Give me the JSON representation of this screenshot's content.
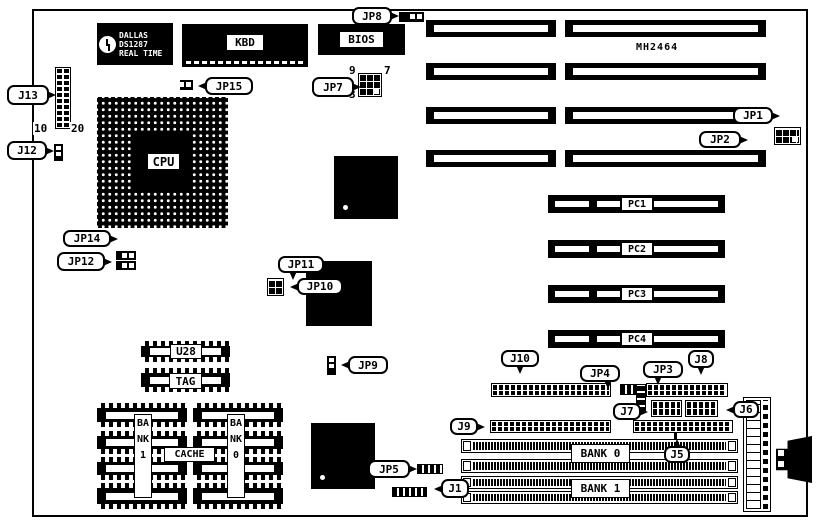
{
  "chips": {
    "dallas_brand": "DALLAS",
    "dallas_model": "DS1287",
    "dallas_sub": "REAL TIME",
    "kbd": "KBD",
    "bios": "BIOS",
    "cpu": "CPU",
    "u28": "U28",
    "tag": "TAG",
    "cache": "CACHE",
    "bank1_col": "BANK1",
    "bank0_col": "BANK0"
  },
  "text": {
    "mh2464": "MH2464"
  },
  "slots": {
    "pc1": "PC1",
    "pc2": "PC2",
    "pc3": "PC3",
    "pc4": "PC4",
    "bank0": "BANK 0",
    "bank1": "BANK 1"
  },
  "callouts": {
    "jp8": "JP8",
    "jp15": "JP15",
    "jp7": "JP7",
    "jp1": "JP1",
    "jp2": "JP2",
    "j13": "J13",
    "j12": "J12",
    "jp14": "JP14",
    "jp12": "JP12",
    "jp11": "JP11",
    "jp10": "JP10",
    "jp9": "JP9",
    "jp5": "JP5",
    "j10": "J10",
    "jp4": "JP4",
    "jp3": "JP3",
    "j8": "J8",
    "j7": "J7",
    "j6": "J6",
    "j9": "J9",
    "j5": "J5",
    "j1": "J1"
  },
  "pins": {
    "jp7_top_left": "9",
    "jp7_top_right": "7",
    "jp7_bottom_left": "3",
    "j13_left": "10",
    "j13_right": "20"
  },
  "colors": {
    "ink": "#000000",
    "paper": "#ffffff"
  }
}
